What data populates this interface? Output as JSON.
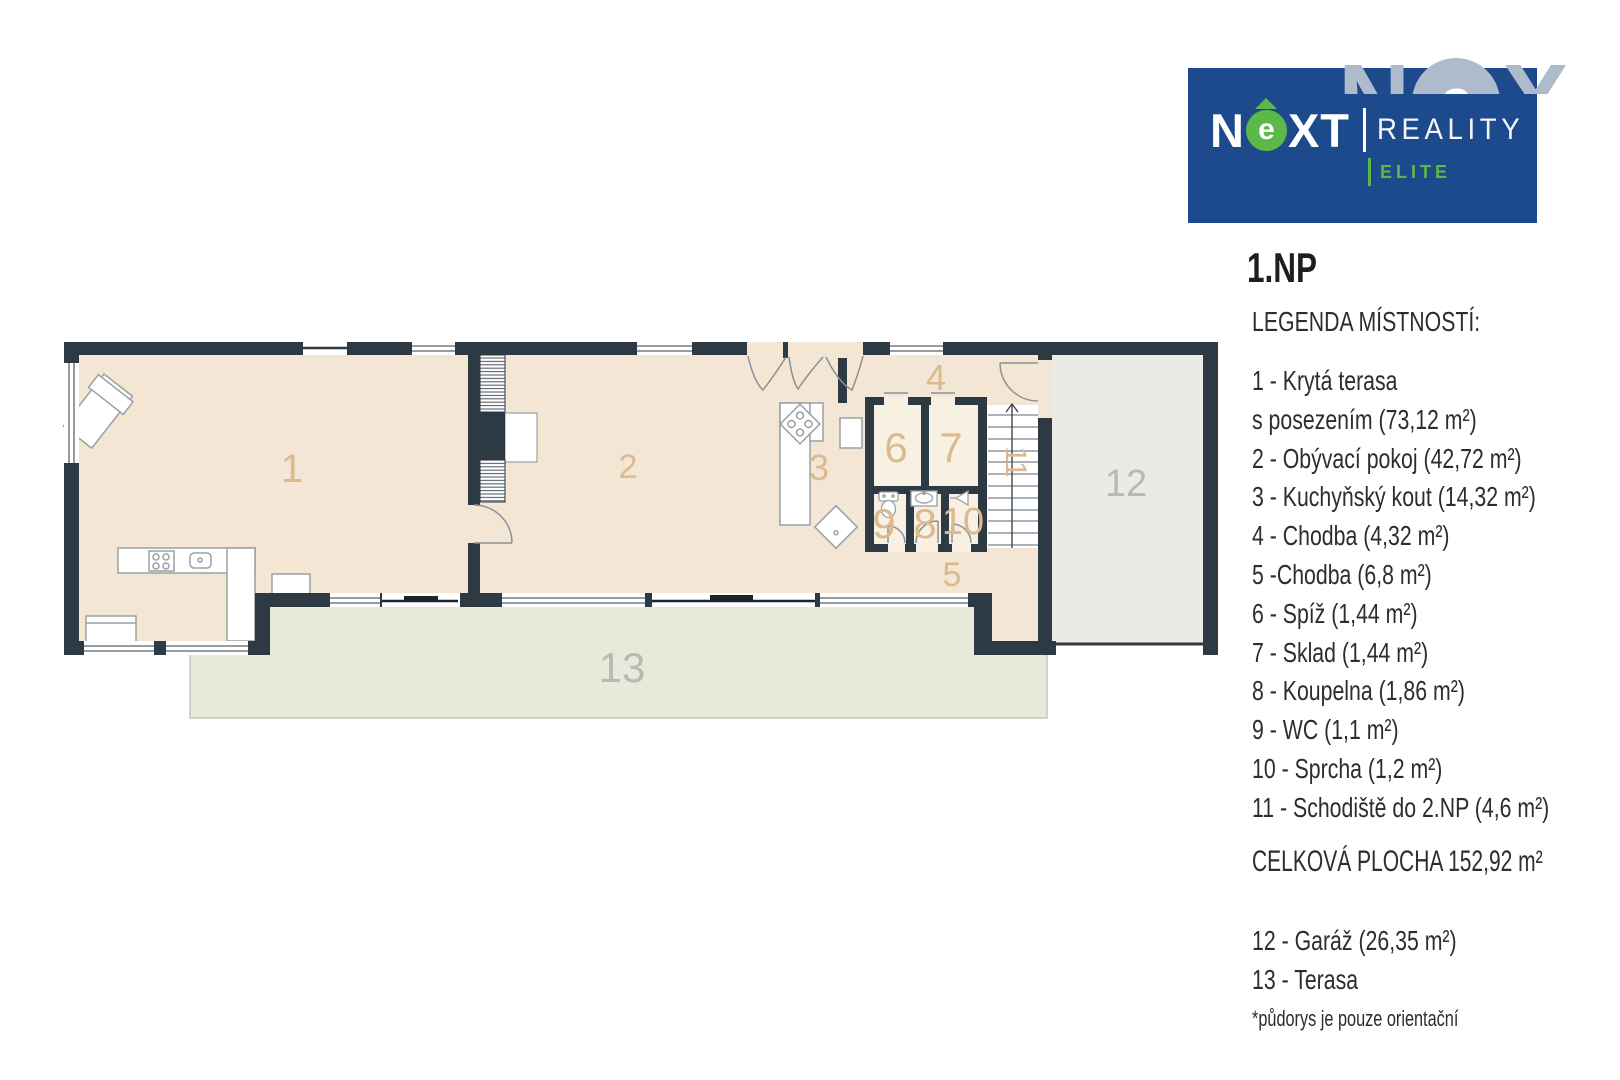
{
  "logo": {
    "brand_n": "N",
    "brand_e": "e",
    "brand_xt": "XT",
    "reality": "REALITY",
    "elite": "ELITE",
    "watermark_n": "N",
    "watermark_e": "e",
    "watermark_x": "X",
    "colors": {
      "blue": "#1d4a8c",
      "green": "#5cb947",
      "watermark": "#aebbcd"
    }
  },
  "title": "1.NP",
  "legend": {
    "heading": "LEGENDA MÍSTNOSTÍ:",
    "items": [
      "1 - Krytá terasa",
      "s posezením (73,12 m²)",
      "2 - Obývací pokoj (42,72 m²)",
      "3 - Kuchyňský kout (14,32 m²)",
      "4 - Chodba (4,32 m²)",
      "5 -Chodba (6,8 m²)",
      "6 - Spíž (1,44 m²)",
      "7 - Sklad (1,44 m²)",
      "8 - Koupelna (1,86 m²)",
      "9 - WC (1,1 m²)",
      "10 - Sprcha (1,2 m²)",
      "11 - Schodiště do 2.NP (4,6 m²)"
    ],
    "total": "CELKOVÁ PLOCHA 152,92 m²",
    "extra_items": [
      "12 - Garáž (26,35 m²)",
      "13 - Terasa"
    ],
    "footnote": "*půdorys je pouze orientační"
  },
  "plan": {
    "labels": [
      "1",
      "2",
      "3",
      "4",
      "5",
      "6",
      "7",
      "8",
      "9",
      "10",
      "11",
      "12",
      "13"
    ],
    "colors": {
      "wall": "#2d3943",
      "floor": "#f3e6d4",
      "floor_light": "#f8f1e3",
      "garage": "#ebebe5",
      "terrace": "#e9e9db",
      "label_tan": "#dcba8e",
      "label_gray": "#b8bab1"
    }
  }
}
